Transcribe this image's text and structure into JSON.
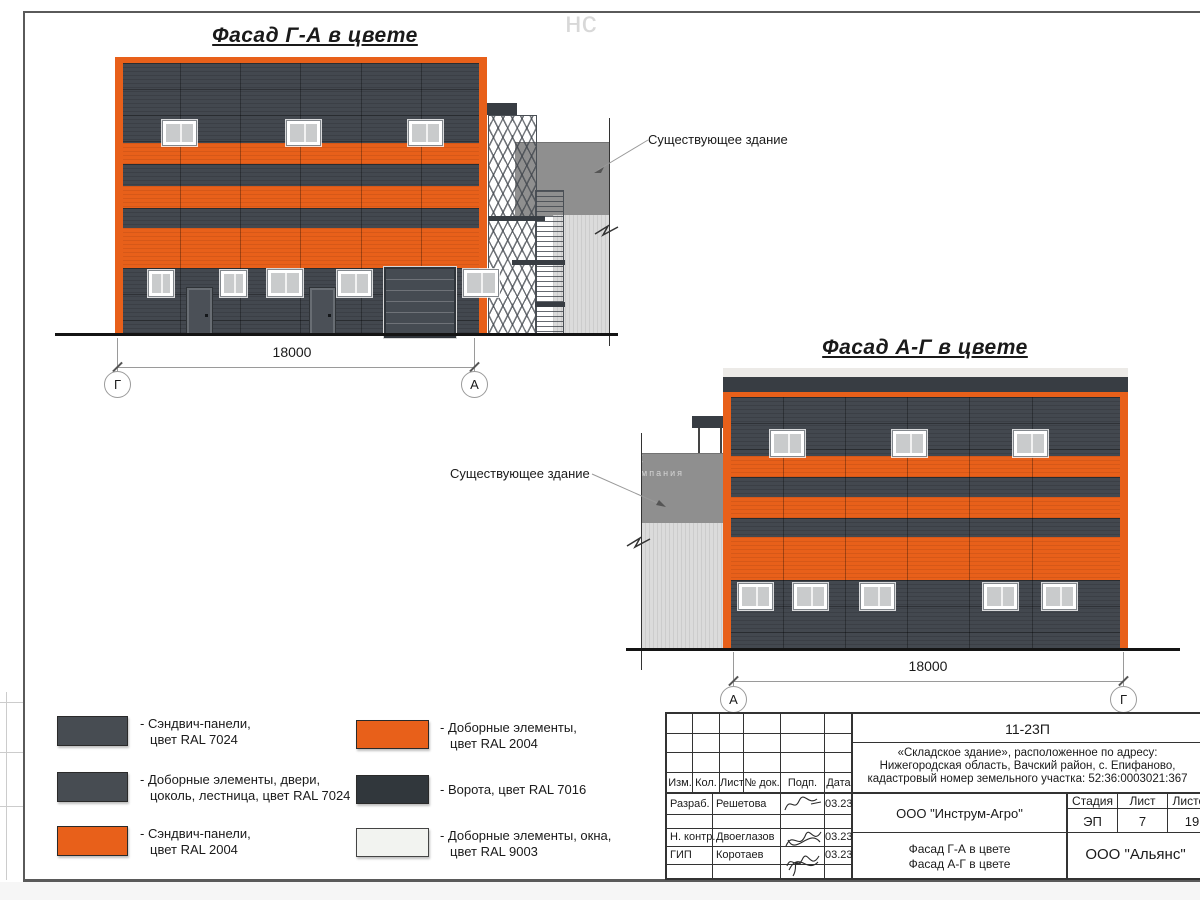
{
  "colors": {
    "ral_7024": "#474C52",
    "ral_2004": "#E8601A",
    "ral_7016": "#31373C",
    "ral_9003": "#F2F3F0"
  },
  "facade1": {
    "title": "Фасад Г-А в цвете",
    "dimension": "18000",
    "axis_left": "Г",
    "axis_right": "А",
    "existing_building_label": "Существующее здание"
  },
  "facade2": {
    "title": "Фасад А-Г в цвете",
    "dimension": "18000",
    "axis_left": "А",
    "axis_right": "Г",
    "existing_building_label": "Существующее здание"
  },
  "legend": {
    "column1": [
      {
        "color": "#474C52",
        "line1": "- Сэндвич-панели,",
        "line2": "цвет RAL 7024"
      },
      {
        "color": "#474C52",
        "line1": "- Доборные элементы, двери,",
        "line2": "цоколь, лестница, цвет RAL 7024"
      },
      {
        "color": "#E8601A",
        "line1": "- Сэндвич-панели,",
        "line2": "цвет RAL 2004"
      }
    ],
    "column2": [
      {
        "color": "#E8601A",
        "line1": "- Доборные элементы,",
        "line2": "цвет RAL 2004"
      },
      {
        "color": "#31373C",
        "line1": "- Ворота, цвет RAL 7016",
        "line2": ""
      },
      {
        "color": "#F2F3F0",
        "line1": "- Доборные элементы, окна,",
        "line2": "цвет RAL 9003"
      }
    ]
  },
  "title_block": {
    "doc_number": "11-23П",
    "project_line1": "«Складское здание», расположенное по адресу:",
    "project_line2": "Нижегородская область, Вачский район, с. Епифаново,",
    "project_line3": "кадастровый номер земельного участка: 52:36:0003021:367",
    "columns": {
      "izm": "Изм.",
      "kol": "Кол.",
      "list": "Лист",
      "doc": "№ док.",
      "podp": "Подп.",
      "data": "Дата"
    },
    "rows": [
      {
        "role": "Разраб.",
        "name": "Решетова",
        "date": "03.23"
      },
      {
        "role": "Н. контр.",
        "name": "Двоеглазов",
        "date": "03.23"
      },
      {
        "role": "ГИП",
        "name": "Коротаев",
        "date": "03.23"
      }
    ],
    "developer": "ООО \"Инструм-Агро\"",
    "sheet_name_line1": "Фасад Г-А в цвете",
    "sheet_name_line2": "Фасад А-Г в цвете",
    "stage_label": "Стадия",
    "sheet_label": "Лист",
    "sheets_label": "Листов",
    "stage": "ЭП",
    "sheet": "7",
    "sheets": "19",
    "contractor": "ООО \"Альянс\""
  },
  "watermark": {
    "fragment_top": "нс",
    "fragment_mid": "нс",
    "fragment_small": "компания"
  }
}
